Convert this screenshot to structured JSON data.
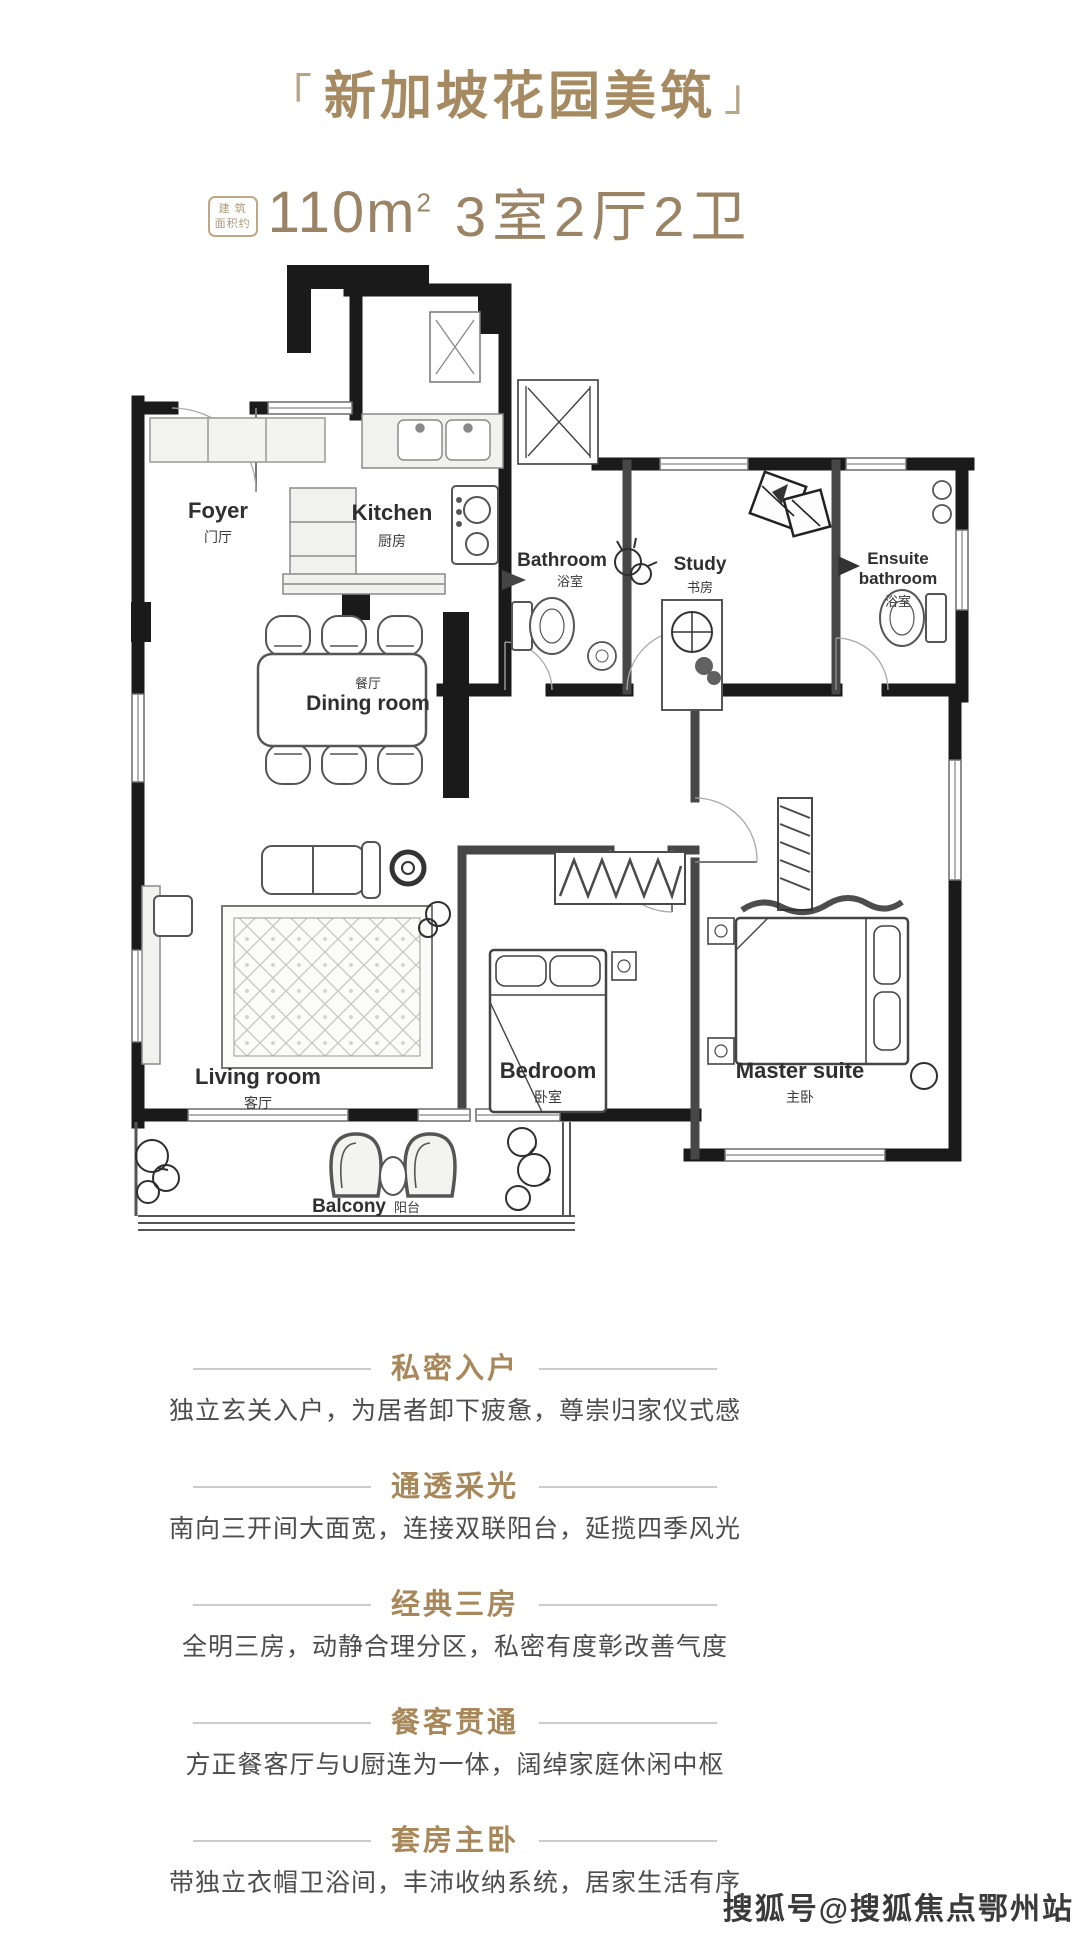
{
  "header": {
    "bracket_left": "「",
    "title": "新加坡花园美筑",
    "bracket_right": "」",
    "badge_line1": "建 筑",
    "badge_line2": "面积约",
    "area_value": "110m",
    "area_sup": "2",
    "layout_value": "3室2厅2卫"
  },
  "floor_plan": {
    "rooms": [
      {
        "id": "foyer",
        "en": "Foyer",
        "zh": "门厅"
      },
      {
        "id": "kitchen",
        "en": "Kitchen",
        "zh": "厨房"
      },
      {
        "id": "bathroom",
        "en": "Bathroom",
        "zh": "浴室"
      },
      {
        "id": "study",
        "en": "Study",
        "zh": "书房"
      },
      {
        "id": "ensuite",
        "en_line1": "Ensuite",
        "en_line2": "bathroom",
        "zh": "浴室"
      },
      {
        "id": "dining",
        "zh": "餐厅",
        "en": "Dining room"
      },
      {
        "id": "living",
        "en": "Living room",
        "zh": "客厅"
      },
      {
        "id": "bedroom",
        "en": "Bedroom",
        "zh": "卧室"
      },
      {
        "id": "master",
        "en": "Master suite",
        "zh": "主卧"
      },
      {
        "id": "balcony",
        "en": "Balcony",
        "zh": "阳台"
      }
    ]
  },
  "features": [
    {
      "title": "私密入户",
      "desc": "独立玄关入户，为居者卸下疲惫，尊崇归家仪式感"
    },
    {
      "title": "通透采光",
      "desc": "南向三开间大面宽，连接双联阳台，延揽四季风光"
    },
    {
      "title": "经典三房",
      "desc": "全明三房，动静合理分区，私密有度彰改善气度"
    },
    {
      "title": "餐客贯通",
      "desc": "方正餐客厅与U厨连为一体，阔绰家庭休闲中枢"
    },
    {
      "title": "套房主卧",
      "desc": "带独立衣帽卫浴间，丰沛收纳系统，居家生活有序"
    }
  ],
  "watermark": "搜狐号@搜狐焦点鄂州站",
  "colors": {
    "accent": "#a58a62",
    "feature_title": "#a8885a",
    "divider": "#cccccc",
    "body_text": "#4d4d4d",
    "wall": "#1a1a1a",
    "watermark": "#3a3a3a"
  }
}
